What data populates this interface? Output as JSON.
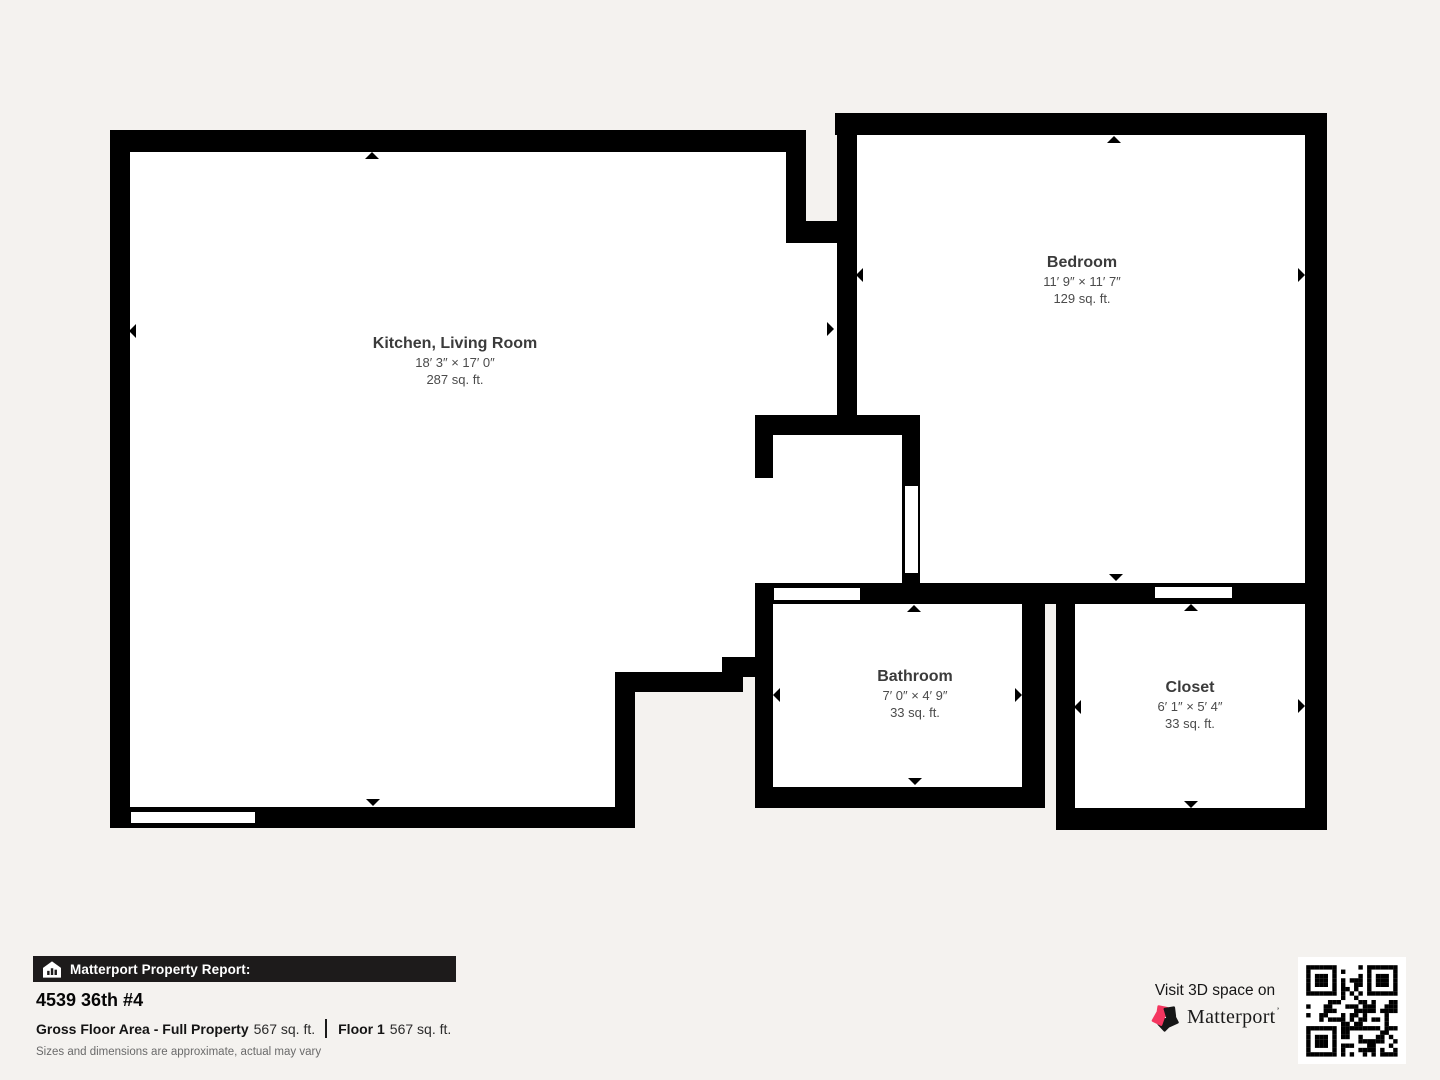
{
  "title": "Matterport Property Report",
  "colors": {
    "background": "#f4f2ef",
    "wall": "#000000",
    "room_fill": "#ffffff",
    "banner_bg": "#1d1b1b",
    "brand_pink": "#f4365f"
  },
  "floorplan": {
    "rooms": [
      {
        "id": "kitchen-living-room",
        "name": "Kitchen, Living Room",
        "dimensions": "18′ 3″ × 17′ 0″",
        "area": "287 sq. ft.",
        "label_x": 455,
        "label_y": 335
      },
      {
        "id": "bedroom",
        "name": "Bedroom",
        "dimensions": "11′ 9″ × 11′ 7″",
        "area": "129 sq. ft.",
        "label_x": 1082,
        "label_y": 254
      },
      {
        "id": "bathroom",
        "name": "Bathroom",
        "dimensions": "7′ 0″ × 4′ 9″",
        "area": "33 sq. ft.",
        "label_x": 915,
        "label_y": 668
      },
      {
        "id": "closet",
        "name": "Closet",
        "dimensions": "6′ 1″ × 5′ 4″",
        "area": "33 sq. ft.",
        "label_x": 1190,
        "label_y": 679
      }
    ],
    "interiors": [
      {
        "x": 130,
        "y": 152,
        "w": 485,
        "h": 655
      },
      {
        "x": 615,
        "y": 152,
        "w": 171,
        "h": 520
      },
      {
        "x": 786,
        "y": 243,
        "w": 51,
        "h": 192
      },
      {
        "x": 755,
        "y": 435,
        "w": 148,
        "h": 148
      },
      {
        "x": 857,
        "y": 135,
        "w": 448,
        "h": 448
      },
      {
        "x": 773,
        "y": 603,
        "w": 249,
        "h": 184
      },
      {
        "x": 1075,
        "y": 604,
        "w": 230,
        "h": 204
      }
    ],
    "walls": [
      {
        "x": 110,
        "y": 130,
        "w": 696,
        "h": 22
      },
      {
        "x": 786,
        "y": 130,
        "w": 20,
        "h": 113
      },
      {
        "x": 806,
        "y": 221,
        "w": 31,
        "h": 22
      },
      {
        "x": 837,
        "y": 113,
        "w": 20,
        "h": 304
      },
      {
        "x": 835,
        "y": 113,
        "w": 492,
        "h": 22
      },
      {
        "x": 1305,
        "y": 113,
        "w": 22,
        "h": 492
      },
      {
        "x": 755,
        "y": 583,
        "w": 572,
        "h": 21
      },
      {
        "x": 755,
        "y": 415,
        "w": 165,
        "h": 20
      },
      {
        "x": 755,
        "y": 415,
        "w": 18,
        "h": 63
      },
      {
        "x": 902,
        "y": 433,
        "w": 18,
        "h": 152
      },
      {
        "x": 755,
        "y": 583,
        "w": 18,
        "h": 225
      },
      {
        "x": 755,
        "y": 787,
        "w": 290,
        "h": 21
      },
      {
        "x": 1022,
        "y": 583,
        "w": 23,
        "h": 225
      },
      {
        "x": 1056,
        "y": 602,
        "w": 19,
        "h": 228
      },
      {
        "x": 1056,
        "y": 808,
        "w": 271,
        "h": 22
      },
      {
        "x": 1305,
        "y": 602,
        "w": 22,
        "h": 228
      },
      {
        "x": 110,
        "y": 130,
        "w": 20,
        "h": 698
      },
      {
        "x": 110,
        "y": 807,
        "w": 525,
        "h": 21
      },
      {
        "x": 615,
        "y": 672,
        "w": 20,
        "h": 156
      },
      {
        "x": 615,
        "y": 672,
        "w": 128,
        "h": 20
      },
      {
        "x": 722,
        "y": 657,
        "w": 33,
        "h": 20
      }
    ],
    "openings": [
      {
        "type": "window",
        "x": 131,
        "y": 812,
        "w": 124,
        "h": 11
      },
      {
        "type": "door",
        "x": 774,
        "y": 588,
        "w": 86,
        "h": 12
      },
      {
        "type": "door",
        "x": 905,
        "y": 486,
        "w": 13,
        "h": 87
      },
      {
        "type": "door",
        "x": 1155,
        "y": 587,
        "w": 77,
        "h": 11
      }
    ],
    "arrows": [
      {
        "x": 372,
        "y": 155,
        "dir": "up"
      },
      {
        "x": 133,
        "y": 331,
        "dir": "left"
      },
      {
        "x": 830,
        "y": 329,
        "dir": "right"
      },
      {
        "x": 373,
        "y": 803,
        "dir": "down"
      },
      {
        "x": 1114,
        "y": 139,
        "dir": "up"
      },
      {
        "x": 860,
        "y": 275,
        "dir": "left"
      },
      {
        "x": 1301,
        "y": 275,
        "dir": "right"
      },
      {
        "x": 1116,
        "y": 578,
        "dir": "down"
      },
      {
        "x": 914,
        "y": 608,
        "dir": "up"
      },
      {
        "x": 777,
        "y": 695,
        "dir": "left"
      },
      {
        "x": 1018,
        "y": 695,
        "dir": "right"
      },
      {
        "x": 915,
        "y": 782,
        "dir": "down"
      },
      {
        "x": 1191,
        "y": 607,
        "dir": "up"
      },
      {
        "x": 1078,
        "y": 707,
        "dir": "left"
      },
      {
        "x": 1301,
        "y": 706,
        "dir": "right"
      },
      {
        "x": 1191,
        "y": 805,
        "dir": "down"
      }
    ]
  },
  "footer": {
    "banner_label": "Matterport Property Report:",
    "address": "4539 36th #4",
    "gross_label": "Gross Floor Area - Full Property",
    "gross_value": "567 sq. ft.",
    "floor_label": "Floor 1",
    "floor_value": "567 sq. ft.",
    "disclaimer": "Sizes and dimensions are approximate, actual may vary",
    "visit_text": "Visit 3D space on",
    "brand": "Matterport",
    "brand_tick": "’"
  }
}
